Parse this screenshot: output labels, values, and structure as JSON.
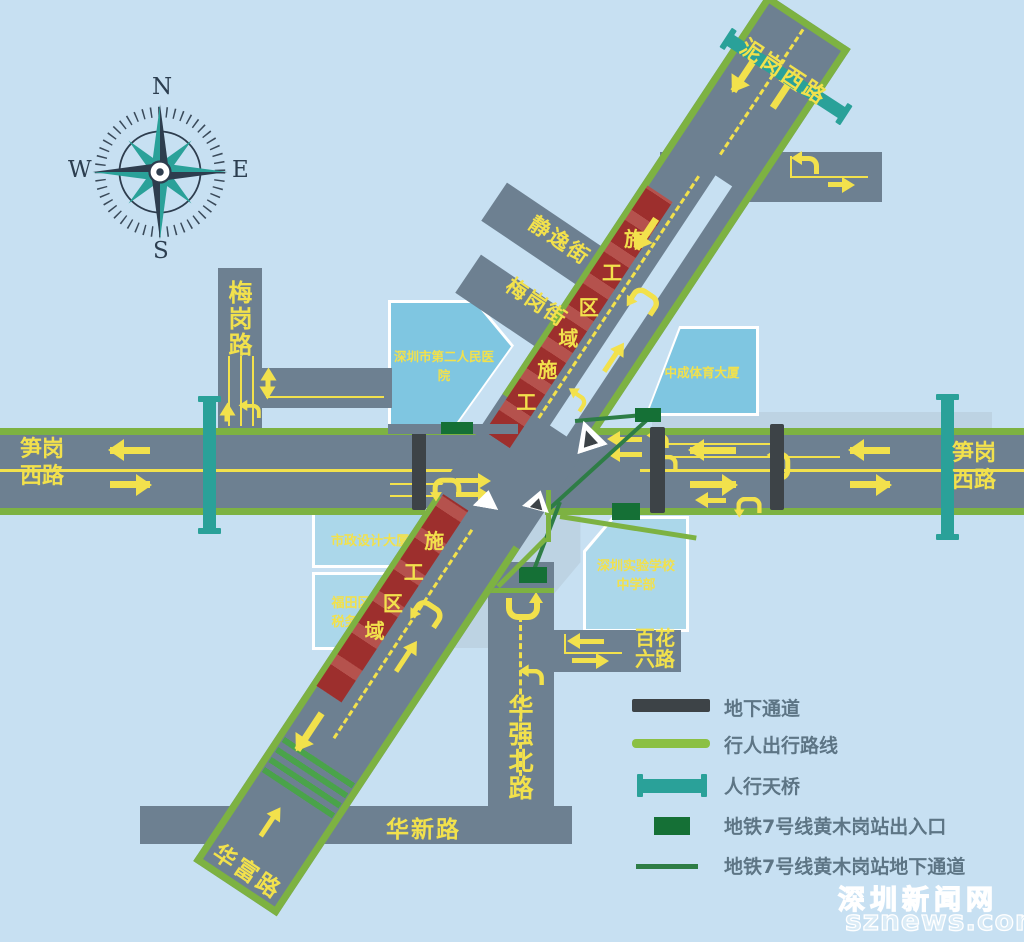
{
  "palette": {
    "background": "#c7e0f2",
    "road": "#6d8091",
    "road_edge_green": "#7db242",
    "marking_yellow": "#f2e14c",
    "footbridge_teal": "#2aa199",
    "metro_entrance_green": "#157036",
    "metro_line_green": "#2e7d46",
    "underground_passage_gray": "#3d4347",
    "construction_red": "#9d2f2d",
    "construction_red_light": "#b5524d",
    "building_blue": "#7fc6e1",
    "building_blue_light": "#abd7ea",
    "legend_text": "#5d7585"
  },
  "compass": {
    "n": "N",
    "e": "E",
    "s": "S",
    "w": "W"
  },
  "roads": {
    "nigang_xi_lu": "泥岗西路",
    "meigang_lu": "梅岗路",
    "sungang_xi_lu_left": "笋岗西路",
    "sungang_xi_lu_right": "笋岗西路",
    "jingyi_jie": "静逸街",
    "meigang_jie": "梅岗街",
    "huaqiang_bei_lu": "华强北路",
    "baihua_liu_lu": "百花六路",
    "huaxin_lu": "华新路",
    "huafu_lu": "华富路"
  },
  "buildings": {
    "hospital": "深圳市第二人民医院",
    "sports_tower": "中成体育大厦",
    "municipal_design_tower": "市政设计大厦",
    "futian_tax_bureau": "福田区税务局",
    "experimental_school": "深圳实验学校中学部"
  },
  "construction": {
    "upper": [
      "施",
      "工",
      "区",
      "域",
      "施",
      "工"
    ],
    "lower": [
      "施",
      "工",
      "区",
      "域"
    ]
  },
  "legend": {
    "items": [
      {
        "icon": "underground-passage-bar",
        "label": "地下通道"
      },
      {
        "icon": "pedestrian-route-line",
        "label": "行人出行路线"
      },
      {
        "icon": "footbridge",
        "label": "人行天桥"
      },
      {
        "icon": "metro-entrance-rect",
        "label": "地铁7号线黄木岗站出入口"
      },
      {
        "icon": "metro-underground-line",
        "label": "地铁7号线黄木岗站地下通道"
      }
    ]
  },
  "watermark": {
    "line1": "深圳新闻网",
    "line2": "sznews.com"
  }
}
